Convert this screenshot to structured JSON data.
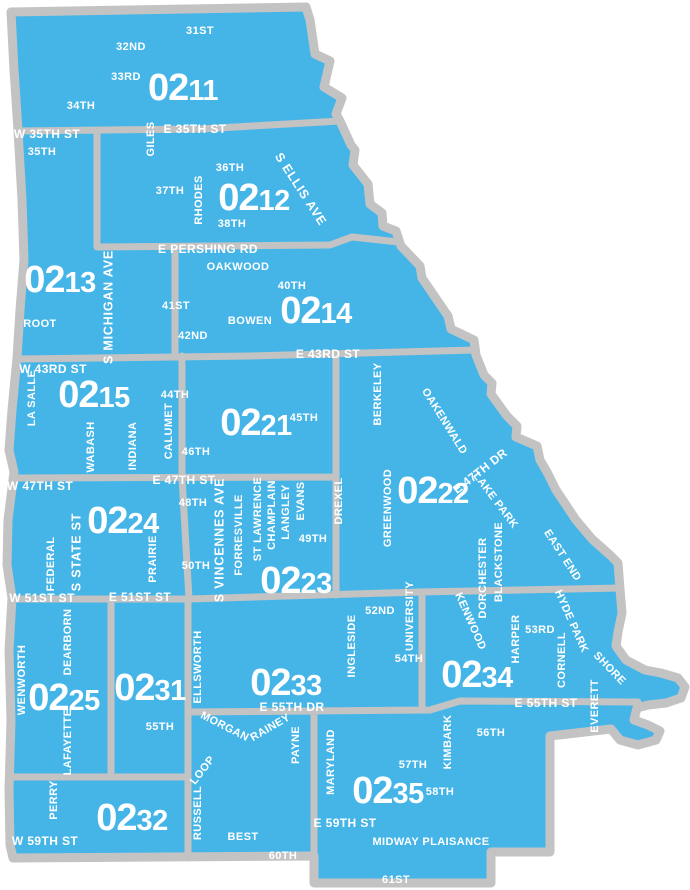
{
  "map": {
    "colors": {
      "beat_fill": "#45B5E8",
      "boundary": "#C3C3C3",
      "label": "#FFFFFF",
      "background": "#FFFFFF"
    },
    "beats": [
      {
        "id": "0211",
        "prefix": "02",
        "suffix": "11",
        "x": 183,
        "y": 100
      },
      {
        "id": "0212",
        "prefix": "02",
        "suffix": "12",
        "x": 254,
        "y": 210
      },
      {
        "id": "0213",
        "prefix": "02",
        "suffix": "13",
        "x": 60,
        "y": 292
      },
      {
        "id": "0214",
        "prefix": "02",
        "suffix": "14",
        "x": 316,
        "y": 323
      },
      {
        "id": "0215",
        "prefix": "02",
        "suffix": "15",
        "x": 94,
        "y": 407
      },
      {
        "id": "0221",
        "prefix": "02",
        "suffix": "21",
        "x": 256,
        "y": 435
      },
      {
        "id": "0222",
        "prefix": "02",
        "suffix": "22",
        "x": 433,
        "y": 503
      },
      {
        "id": "0223",
        "prefix": "02",
        "suffix": "23",
        "x": 296,
        "y": 593
      },
      {
        "id": "0224",
        "prefix": "02",
        "suffix": "24",
        "x": 123,
        "y": 533
      },
      {
        "id": "0225",
        "prefix": "02",
        "suffix": "25",
        "x": 64,
        "y": 710
      },
      {
        "id": "0231",
        "prefix": "02",
        "suffix": "31",
        "x": 150,
        "y": 700
      },
      {
        "id": "0232",
        "prefix": "02",
        "suffix": "32",
        "x": 132,
        "y": 830
      },
      {
        "id": "0233",
        "prefix": "02",
        "suffix": "33",
        "x": 286,
        "y": 695
      },
      {
        "id": "0234",
        "prefix": "02",
        "suffix": "34",
        "x": 477,
        "y": 687
      },
      {
        "id": "0235",
        "prefix": "02",
        "suffix": "35",
        "x": 388,
        "y": 803
      }
    ],
    "street_labels": [
      {
        "text": "31ST",
        "x": 200,
        "y": 30,
        "rot": 0,
        "cls": "st"
      },
      {
        "text": "32ND",
        "x": 131,
        "y": 46,
        "rot": 0,
        "cls": "st"
      },
      {
        "text": "33RD",
        "x": 126,
        "y": 76,
        "rot": 0,
        "cls": "st"
      },
      {
        "text": "34TH",
        "x": 81,
        "y": 105,
        "rot": 0,
        "cls": "st"
      },
      {
        "text": "W 35TH ST",
        "x": 47,
        "y": 134,
        "rot": 0,
        "cls": "onl"
      },
      {
        "text": "E 35TH ST",
        "x": 195,
        "y": 129,
        "rot": 0,
        "cls": "onl"
      },
      {
        "text": "GILES",
        "x": 150,
        "y": 139,
        "rot": -90,
        "cls": "st"
      },
      {
        "text": "35TH",
        "x": 42,
        "y": 151,
        "rot": 0,
        "cls": "st"
      },
      {
        "text": "36TH",
        "x": 230,
        "y": 167,
        "rot": 0,
        "cls": "st"
      },
      {
        "text": "37TH",
        "x": 170,
        "y": 190,
        "rot": 0,
        "cls": "st"
      },
      {
        "text": "RHODES",
        "x": 198,
        "y": 200,
        "rot": -90,
        "cls": "st"
      },
      {
        "text": "S ELLIS AVE",
        "x": 301,
        "y": 189,
        "rot": 57,
        "cls": "art"
      },
      {
        "text": "38TH",
        "x": 232,
        "y": 223,
        "rot": 0,
        "cls": "st"
      },
      {
        "text": "E PERSHING RD",
        "x": 208,
        "y": 249,
        "rot": 0,
        "cls": "onl"
      },
      {
        "text": "OAKWOOD",
        "x": 238,
        "y": 266,
        "rot": 0,
        "cls": "st"
      },
      {
        "text": "40TH",
        "x": 292,
        "y": 285,
        "rot": 0,
        "cls": "st"
      },
      {
        "text": "S MICHIGAN AVE",
        "x": 108,
        "y": 307,
        "rot": -90,
        "cls": "art"
      },
      {
        "text": "41ST",
        "x": 176,
        "y": 305,
        "rot": 0,
        "cls": "st"
      },
      {
        "text": "BOWEN",
        "x": 250,
        "y": 320,
        "rot": 0,
        "cls": "st"
      },
      {
        "text": "ROOT",
        "x": 40,
        "y": 323,
        "rot": 0,
        "cls": "st"
      },
      {
        "text": "42ND",
        "x": 193,
        "y": 335,
        "rot": 0,
        "cls": "st"
      },
      {
        "text": "W 43RD ST",
        "x": 53,
        "y": 369,
        "rot": 0,
        "cls": "onl"
      },
      {
        "text": "E 43RD ST",
        "x": 328,
        "y": 354,
        "rot": 0,
        "cls": "onl"
      },
      {
        "text": "LA SALLE",
        "x": 31,
        "y": 398,
        "rot": -90,
        "cls": "st"
      },
      {
        "text": "44TH",
        "x": 175,
        "y": 394,
        "rot": 0,
        "cls": "st"
      },
      {
        "text": "45TH",
        "x": 304,
        "y": 417,
        "rot": 0,
        "cls": "st"
      },
      {
        "text": "BERKELEY",
        "x": 377,
        "y": 394,
        "rot": -90,
        "cls": "st"
      },
      {
        "text": "OAKENWALD",
        "x": 445,
        "y": 421,
        "rot": 58,
        "cls": "st"
      },
      {
        "text": "WABASH",
        "x": 90,
        "y": 447,
        "rot": -90,
        "cls": "st"
      },
      {
        "text": "INDIANA",
        "x": 132,
        "y": 446,
        "rot": -90,
        "cls": "st"
      },
      {
        "text": "CALUMET",
        "x": 168,
        "y": 431,
        "rot": -90,
        "cls": "st"
      },
      {
        "text": "46TH",
        "x": 196,
        "y": 451,
        "rot": 0,
        "cls": "st"
      },
      {
        "text": "E 47TH DR",
        "x": 480,
        "y": 471,
        "rot": -38,
        "cls": "onl"
      },
      {
        "text": "W 47TH ST",
        "x": 40,
        "y": 486,
        "rot": 0,
        "cls": "onl"
      },
      {
        "text": "E 47TH ST",
        "x": 184,
        "y": 480,
        "rot": 0,
        "cls": "onl"
      },
      {
        "text": "48TH",
        "x": 193,
        "y": 502,
        "rot": 0,
        "cls": "st"
      },
      {
        "text": "GREENWOOD",
        "x": 387,
        "y": 508,
        "rot": -90,
        "cls": "st"
      },
      {
        "text": "LAKE PARK",
        "x": 496,
        "y": 500,
        "rot": 53,
        "cls": "st"
      },
      {
        "text": "DREXEL",
        "x": 338,
        "y": 501,
        "rot": -90,
        "cls": "st"
      },
      {
        "text": "S VINCENNES AVE",
        "x": 219,
        "y": 540,
        "rot": -90,
        "cls": "art"
      },
      {
        "text": "FORRESVILLE",
        "x": 238,
        "y": 535,
        "rot": -90,
        "cls": "st"
      },
      {
        "text": "ST LAWRENCE",
        "x": 257,
        "y": 519,
        "rot": -90,
        "cls": "st"
      },
      {
        "text": "CHAMPLAIN",
        "x": 271,
        "y": 515,
        "rot": -90,
        "cls": "st"
      },
      {
        "text": "LANGLEY",
        "x": 285,
        "y": 512,
        "rot": -90,
        "cls": "st"
      },
      {
        "text": "EVANS",
        "x": 300,
        "y": 501,
        "rot": -90,
        "cls": "st"
      },
      {
        "text": "49TH",
        "x": 313,
        "y": 538,
        "rot": 0,
        "cls": "st"
      },
      {
        "text": "S STATE ST",
        "x": 76,
        "y": 552,
        "rot": -90,
        "cls": "art"
      },
      {
        "text": "FEDERAL",
        "x": 50,
        "y": 564,
        "rot": -90,
        "cls": "st"
      },
      {
        "text": "PRAIRIE",
        "x": 152,
        "y": 559,
        "rot": -90,
        "cls": "st"
      },
      {
        "text": "50TH",
        "x": 196,
        "y": 565,
        "rot": 0,
        "cls": "st"
      },
      {
        "text": "EAST END",
        "x": 563,
        "y": 555,
        "rot": 57,
        "cls": "st"
      },
      {
        "text": "DORCHESTER",
        "x": 482,
        "y": 578,
        "rot": -90,
        "cls": "st"
      },
      {
        "text": "BLACKSTONE",
        "x": 498,
        "y": 562,
        "rot": -90,
        "cls": "st"
      },
      {
        "text": "W 51ST ST",
        "x": 42,
        "y": 598,
        "rot": 0,
        "cls": "onl"
      },
      {
        "text": "E 51ST ST",
        "x": 140,
        "y": 597,
        "rot": 0,
        "cls": "onl"
      },
      {
        "text": "52ND",
        "x": 380,
        "y": 610,
        "rot": 0,
        "cls": "st"
      },
      {
        "text": "KENWOOD",
        "x": 471,
        "y": 621,
        "rot": 66,
        "cls": "st"
      },
      {
        "text": "HYDE PARK",
        "x": 572,
        "y": 621,
        "rot": 66,
        "cls": "st"
      },
      {
        "text": "UNIVERSITY",
        "x": 409,
        "y": 616,
        "rot": -90,
        "cls": "st"
      },
      {
        "text": "INGLESIDE",
        "x": 351,
        "y": 646,
        "rot": -90,
        "cls": "st"
      },
      {
        "text": "53RD",
        "x": 540,
        "y": 629,
        "rot": 0,
        "cls": "st"
      },
      {
        "text": "HARPER",
        "x": 515,
        "y": 639,
        "rot": -90,
        "cls": "st"
      },
      {
        "text": "54TH",
        "x": 409,
        "y": 658,
        "rot": 0,
        "cls": "st"
      },
      {
        "text": "CORNELL",
        "x": 561,
        "y": 660,
        "rot": -90,
        "cls": "st"
      },
      {
        "text": "SHORE",
        "x": 610,
        "y": 668,
        "rot": 46,
        "cls": "st"
      },
      {
        "text": "WENWORTH",
        "x": 21,
        "y": 680,
        "rot": -90,
        "cls": "st"
      },
      {
        "text": "DEARBORN",
        "x": 67,
        "y": 642,
        "rot": -90,
        "cls": "st"
      },
      {
        "text": "LAFAYETTE",
        "x": 67,
        "y": 742,
        "rot": -90,
        "cls": "st"
      },
      {
        "text": "ELLSWORTH",
        "x": 197,
        "y": 667,
        "rot": -90,
        "cls": "st"
      },
      {
        "text": "E 55TH ST",
        "x": 546,
        "y": 703,
        "rot": 0,
        "cls": "onl"
      },
      {
        "text": "E 55TH DR",
        "x": 292,
        "y": 707,
        "rot": 0,
        "cls": "onl"
      },
      {
        "text": "EVERETT",
        "x": 594,
        "y": 706,
        "rot": -90,
        "cls": "st"
      },
      {
        "text": "MORGAN",
        "x": 225,
        "y": 726,
        "rot": 27,
        "cls": "st"
      },
      {
        "text": "RAINEY",
        "x": 270,
        "y": 727,
        "rot": -30,
        "cls": "st"
      },
      {
        "text": "PAYNE",
        "x": 295,
        "y": 745,
        "rot": -90,
        "cls": "st"
      },
      {
        "text": "55TH",
        "x": 160,
        "y": 726,
        "rot": 0,
        "cls": "st"
      },
      {
        "text": "56TH",
        "x": 491,
        "y": 732,
        "rot": 0,
        "cls": "st"
      },
      {
        "text": "MARYLAND",
        "x": 330,
        "y": 762,
        "rot": -90,
        "cls": "st"
      },
      {
        "text": "KIMBARK",
        "x": 447,
        "y": 742,
        "rot": -90,
        "cls": "st"
      },
      {
        "text": "57TH",
        "x": 413,
        "y": 764,
        "rot": 0,
        "cls": "st"
      },
      {
        "text": "LOOP",
        "x": 202,
        "y": 770,
        "rot": -52,
        "cls": "st"
      },
      {
        "text": "PERRY",
        "x": 53,
        "y": 800,
        "rot": -90,
        "cls": "st"
      },
      {
        "text": "58TH",
        "x": 440,
        "y": 791,
        "rot": 0,
        "cls": "st"
      },
      {
        "text": "RUSSELL",
        "x": 197,
        "y": 813,
        "rot": -90,
        "cls": "st"
      },
      {
        "text": "W 59TH ST",
        "x": 45,
        "y": 841,
        "rot": 0,
        "cls": "onl"
      },
      {
        "text": "E 59TH ST",
        "x": 345,
        "y": 823,
        "rot": 0,
        "cls": "onl"
      },
      {
        "text": "BEST",
        "x": 243,
        "y": 836,
        "rot": 0,
        "cls": "st"
      },
      {
        "text": "MIDWAY PLAISANCE",
        "x": 431,
        "y": 841,
        "rot": 0,
        "cls": "st"
      },
      {
        "text": "60TH",
        "x": 283,
        "y": 855,
        "rot": 0,
        "cls": "st"
      },
      {
        "text": "61ST",
        "x": 396,
        "y": 879,
        "rot": 0,
        "cls": "st"
      }
    ]
  }
}
